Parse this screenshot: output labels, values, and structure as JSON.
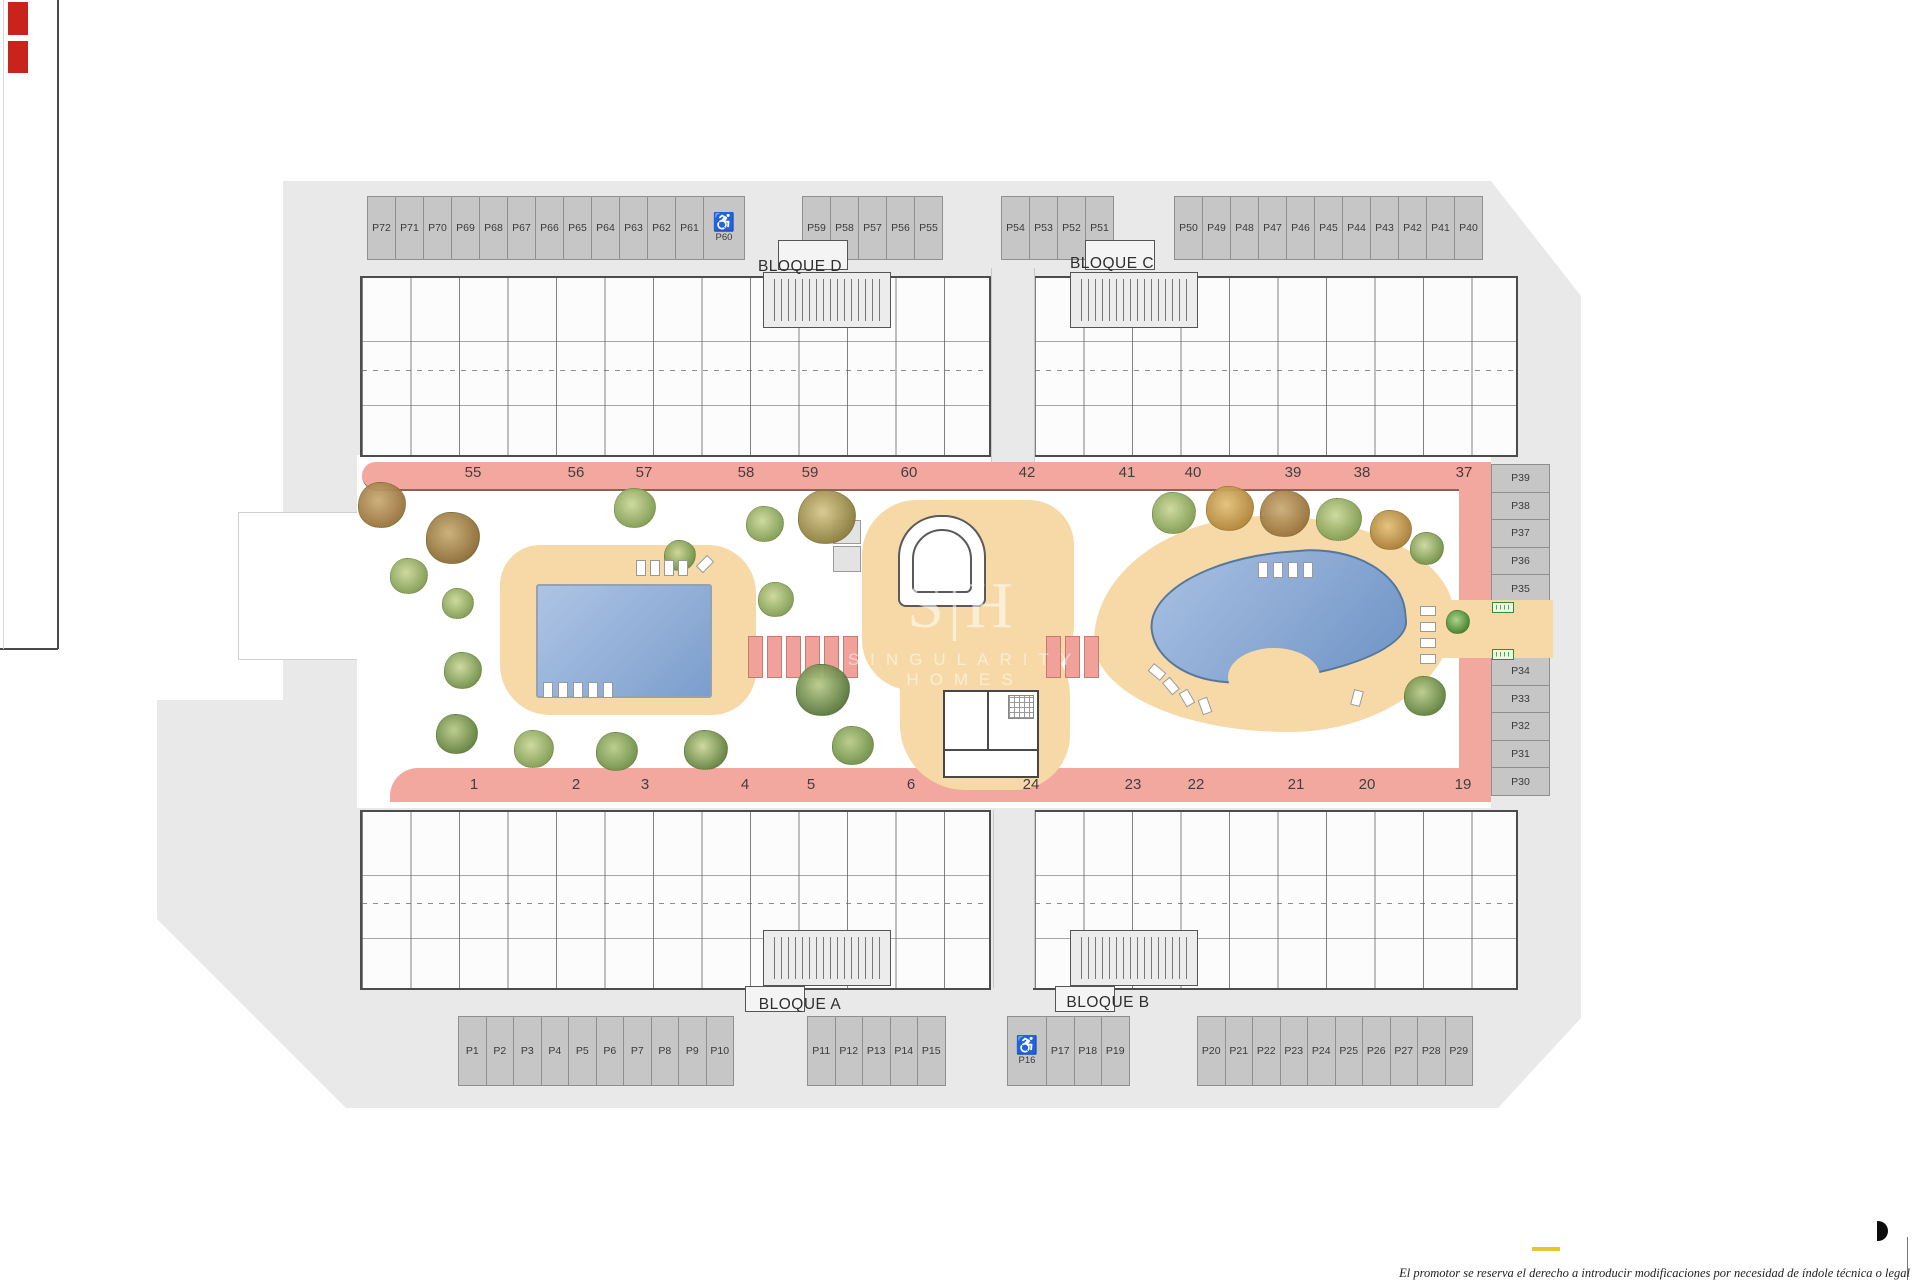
{
  "sheet": {
    "disclaimer": "El promotor se reserva el derecho a introducir modificaciones por necesidad de índole técnica o legal",
    "watermark": {
      "monogram": "S|H",
      "name": "SINGULARITY HOMES"
    }
  },
  "icons": {
    "accessible_parking": "♿"
  },
  "blocks": {
    "d": "BLOQUE D",
    "c": "BLOQUE C",
    "a": "BLOQUE A",
    "b": "BLOQUE B"
  },
  "parking": {
    "top_left": [
      "P72",
      "P71",
      "P70",
      "P69",
      "P68",
      "P67",
      "P66",
      "P65",
      "P64",
      "P63",
      "P62",
      "P61"
    ],
    "top_left_disabled": "P60",
    "top_mid_1": [
      "P59",
      "P58",
      "P57",
      "P56",
      "P55"
    ],
    "top_mid_2": [
      "P54",
      "P53",
      "P52",
      "P51"
    ],
    "top_right": [
      "P50",
      "P49",
      "P48",
      "P47",
      "P46",
      "P45",
      "P44",
      "P43",
      "P42",
      "P41",
      "P40"
    ],
    "right_upper": [
      "P39",
      "P38",
      "P37",
      "P36",
      "P35"
    ],
    "right_lower": [
      "P34",
      "P33",
      "P32",
      "P31",
      "P30"
    ],
    "bottom_left": [
      "P1",
      "P2",
      "P3",
      "P4",
      "P5",
      "P6",
      "P7",
      "P8",
      "P9",
      "P10"
    ],
    "bottom_mid": [
      "P11",
      "P12",
      "P13",
      "P14",
      "P15"
    ],
    "bottom_disabled": "P16",
    "bottom_mid_2": [
      "P17",
      "P18",
      "P19"
    ],
    "bottom_right": [
      "P20",
      "P21",
      "P22",
      "P23",
      "P24",
      "P25",
      "P26",
      "P27",
      "P28",
      "P29"
    ]
  },
  "units": {
    "top_row": [
      {
        "label": "55",
        "x": 473
      },
      {
        "label": "56",
        "x": 576
      },
      {
        "label": "57",
        "x": 644
      },
      {
        "label": "58",
        "x": 746
      },
      {
        "label": "59",
        "x": 810
      },
      {
        "label": "60",
        "x": 909
      },
      {
        "label": "42",
        "x": 1027
      },
      {
        "label": "41",
        "x": 1127
      },
      {
        "label": "40",
        "x": 1193
      },
      {
        "label": "39",
        "x": 1293
      },
      {
        "label": "38",
        "x": 1362
      },
      {
        "label": "37",
        "x": 1464
      }
    ],
    "bottom_row": [
      {
        "label": "1",
        "x": 474
      },
      {
        "label": "2",
        "x": 576
      },
      {
        "label": "3",
        "x": 645
      },
      {
        "label": "4",
        "x": 745
      },
      {
        "label": "5",
        "x": 811
      },
      {
        "label": "6",
        "x": 911
      },
      {
        "label": "24",
        "x": 1031
      },
      {
        "label": "23",
        "x": 1133
      },
      {
        "label": "22",
        "x": 1196
      },
      {
        "label": "21",
        "x": 1296
      },
      {
        "label": "20",
        "x": 1367
      },
      {
        "label": "19",
        "x": 1463
      }
    ]
  },
  "colors": {
    "road": "#e9e9e9",
    "stall": "#c6c6c6",
    "path_pink": "#f3a89f",
    "deck_tan": "#f6d9a6",
    "pool_blue": "#7f9fce",
    "corner_mark_red": "#c9241c"
  }
}
